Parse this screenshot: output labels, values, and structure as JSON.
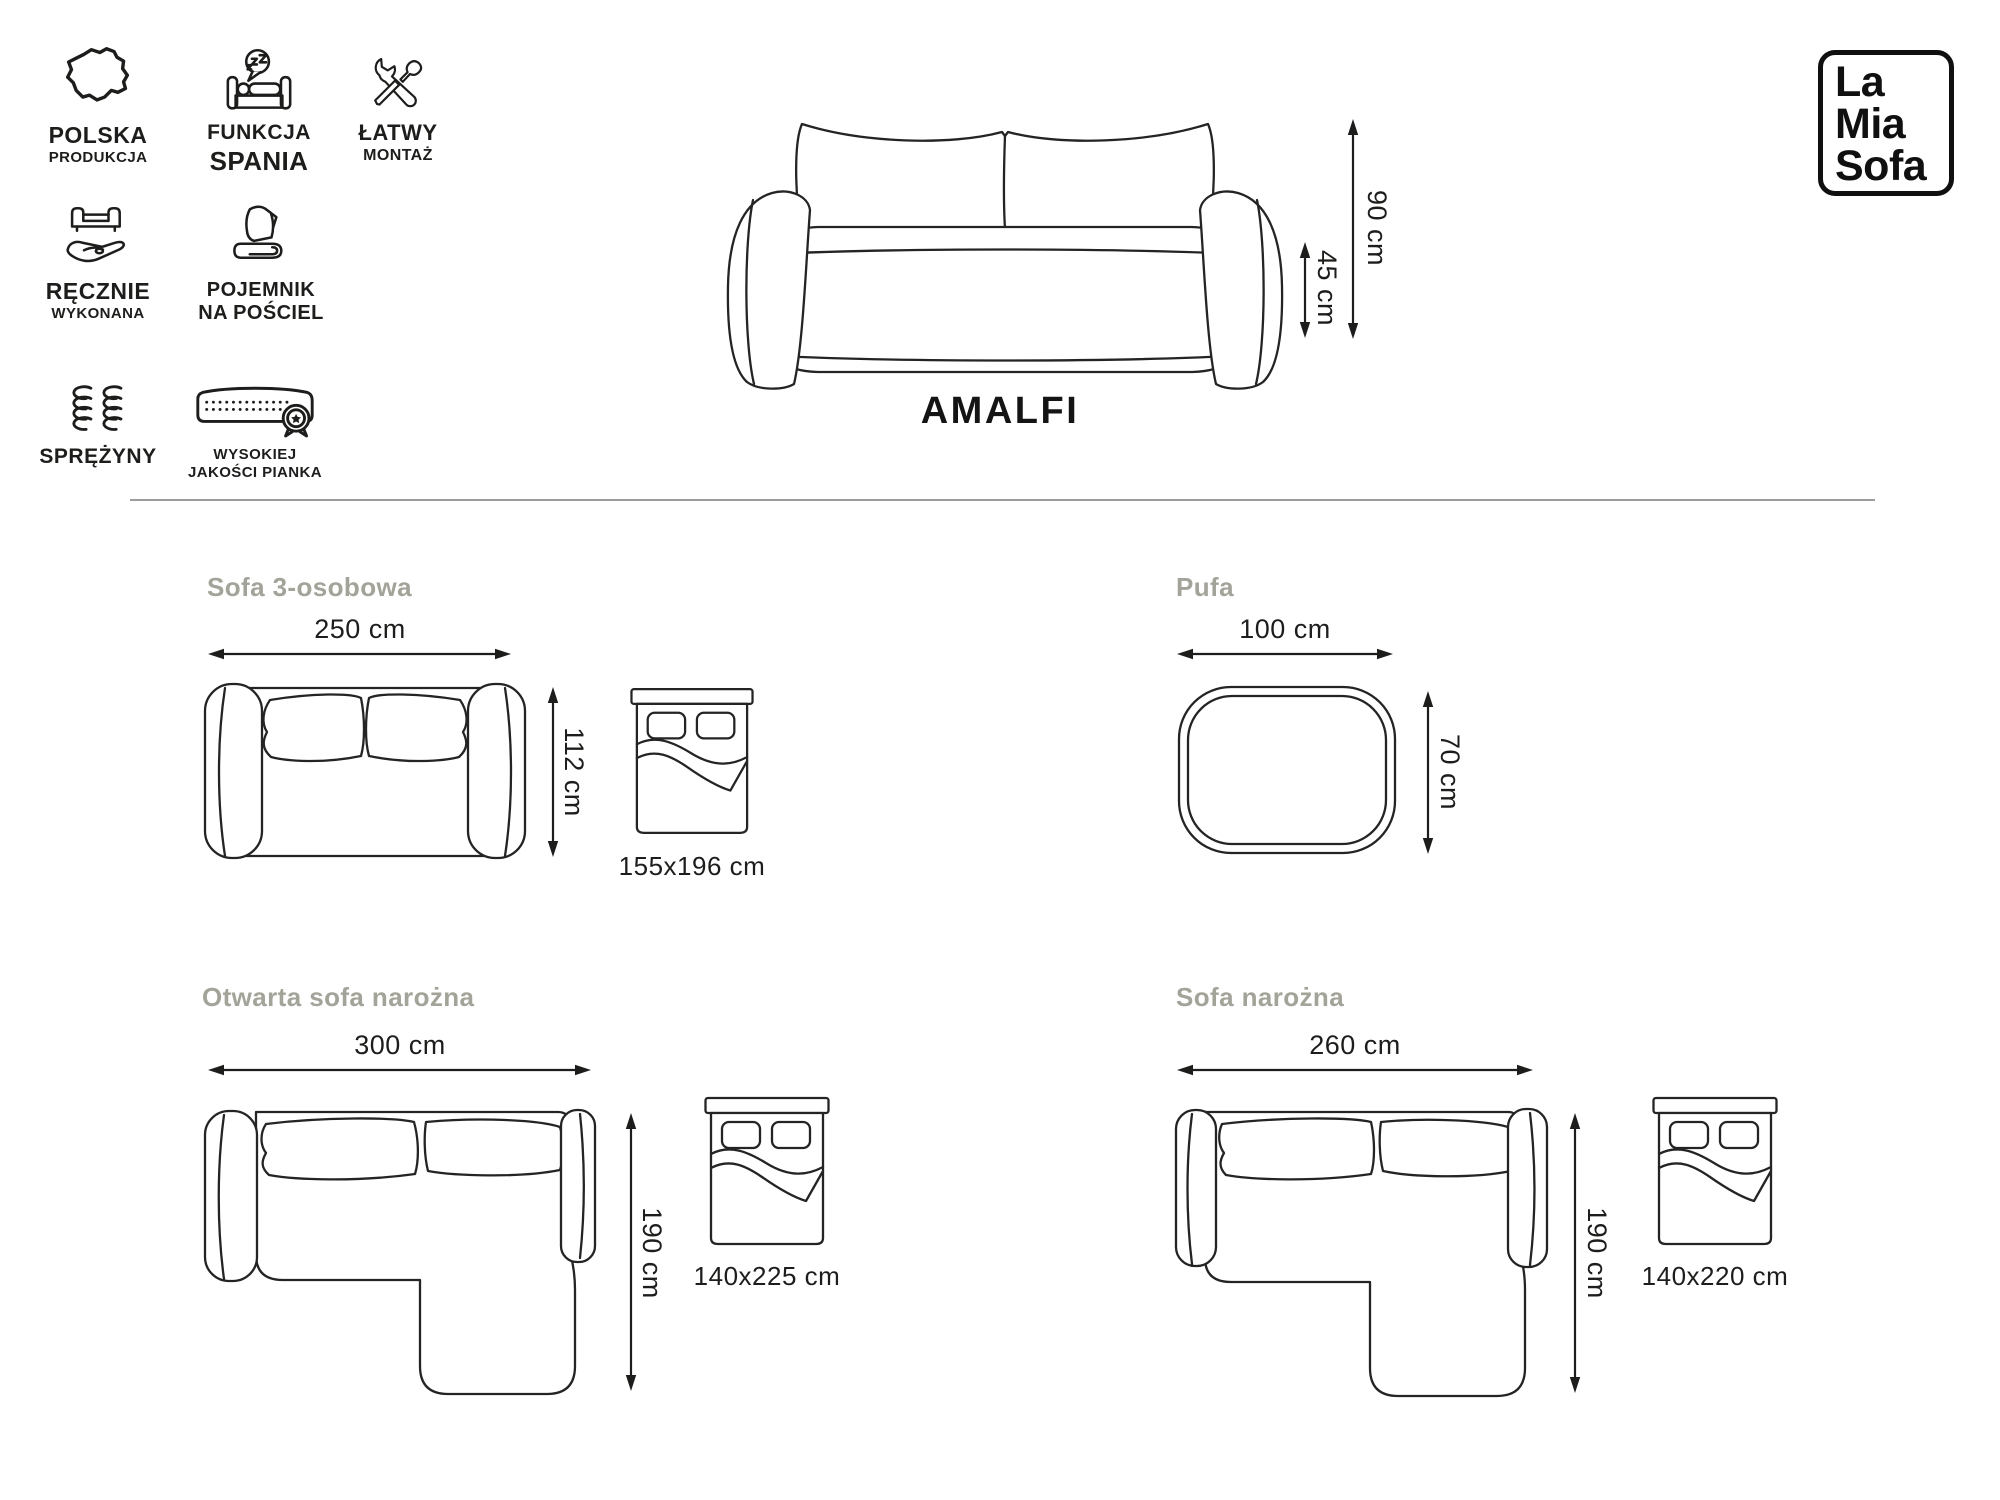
{
  "colors": {
    "ink": "#1d1d1b",
    "line_art": "#242424",
    "heading_gray": "#a3a399",
    "divider": "#9d9d9d",
    "background": "#ffffff"
  },
  "brand": {
    "line1": "La",
    "line2": "Mia",
    "line3": "Sofa"
  },
  "features": [
    {
      "name": "polska-produkcja",
      "line1": "POLSKA",
      "line2": "PRODUKCJA"
    },
    {
      "name": "funkcja-spania",
      "line1": "FUNKCJA",
      "line2": "SPANIA"
    },
    {
      "name": "latwy-montaz",
      "line1": "ŁATWY",
      "line2": "MONTAŻ"
    },
    {
      "name": "recznie-wykonana",
      "line1": "RĘCZNIE",
      "line2": "WYKONANA"
    },
    {
      "name": "pojemnik-na-posciel",
      "line1": "POJEMNIK",
      "line2": "NA POŚCIEL"
    },
    {
      "name": "sprezyny",
      "line1": "SPRĘŻYNY",
      "line2": ""
    },
    {
      "name": "wysokiej-jakosci-pianka",
      "line1": "WYSOKIEJ",
      "line2": "JAKOŚCI PIANKA"
    }
  ],
  "product": {
    "name": "AMALFI",
    "total_height": "90 cm",
    "seat_height": "45 cm"
  },
  "sections": [
    {
      "title": "Sofa 3-osobowa",
      "width": "250 cm",
      "depth": "112 cm",
      "bed_size": "155x196 cm"
    },
    {
      "title": "Pufa",
      "width": "100 cm",
      "depth": "70 cm"
    },
    {
      "title": "Otwarta sofa narożna",
      "width": "300 cm",
      "depth": "190 cm",
      "bed_size": "140x225 cm"
    },
    {
      "title": "Sofa narożna",
      "width": "260 cm",
      "depth": "190 cm",
      "bed_size": "140x220 cm"
    }
  ]
}
